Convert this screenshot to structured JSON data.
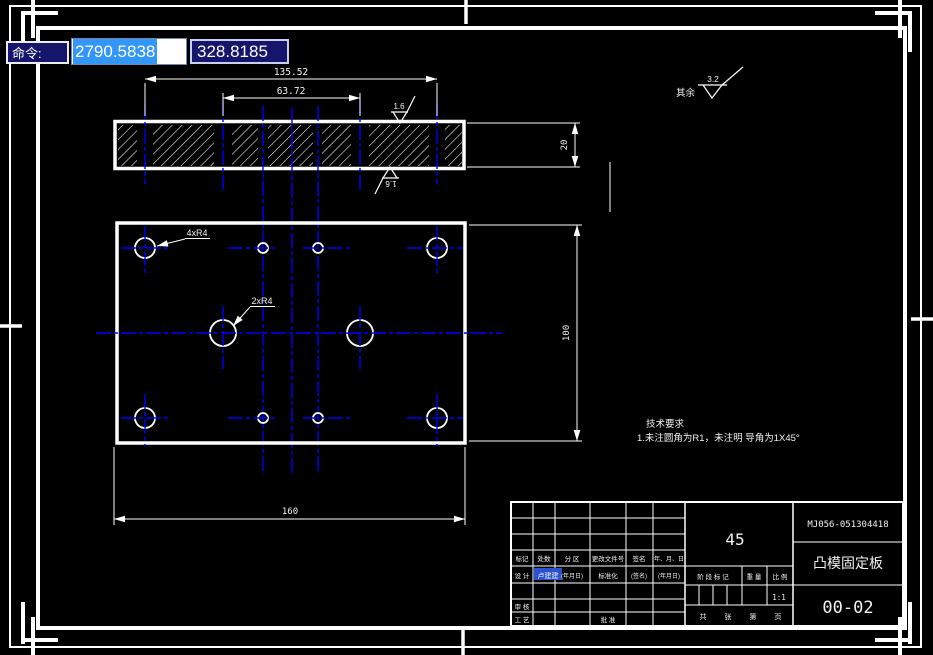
{
  "command_bar": {
    "label": "命令:",
    "x_value": "2790.5838",
    "y_value": "328.8185"
  },
  "colors": {
    "centerline": "#0000ff",
    "line": "#ffffff",
    "highlight_bg": "#3296fa",
    "cmd_bg": "#15156b"
  },
  "views": {
    "section": {
      "dim_overall": "135.52",
      "dim_inner": "63.72",
      "dim_thickness": "20",
      "roughness_top": "1.6",
      "roughness_bottom": "1.6"
    },
    "plan": {
      "corner_holes_label": "4xR4",
      "center_holes_label": "2xR4",
      "dim_width": "160",
      "dim_height": "100"
    }
  },
  "notes": {
    "heading": "技术要求",
    "line1": "1.未注圆角为R1，未注明 导角为1X45°"
  },
  "general_roughness": {
    "prefix": "其余",
    "value": "3.2"
  },
  "title_block": {
    "header_row": [
      "标记",
      "处数",
      "分 区",
      "更改文件号",
      "签名",
      "年、月、日"
    ],
    "design_label": "设 计",
    "designer_name": "卢建建",
    "date_placeholder": "(年月日)",
    "standardization_label": "标准化",
    "signature_placeholder": "(签名)",
    "date_placeholder2": "(年月日)",
    "review_label": "审 核",
    "process_label": "工 艺",
    "approve_label": "批 准",
    "material": "45",
    "stage_label": "阶 段 标 记",
    "weight_label": "重 量",
    "scale_label": "比 例",
    "scale_value": "1:1",
    "footer": [
      "共",
      "张",
      "第",
      "页"
    ],
    "drawing_code": "MJ056-051304418",
    "part_name": "凸模固定板",
    "sheet_number": "00-02"
  }
}
